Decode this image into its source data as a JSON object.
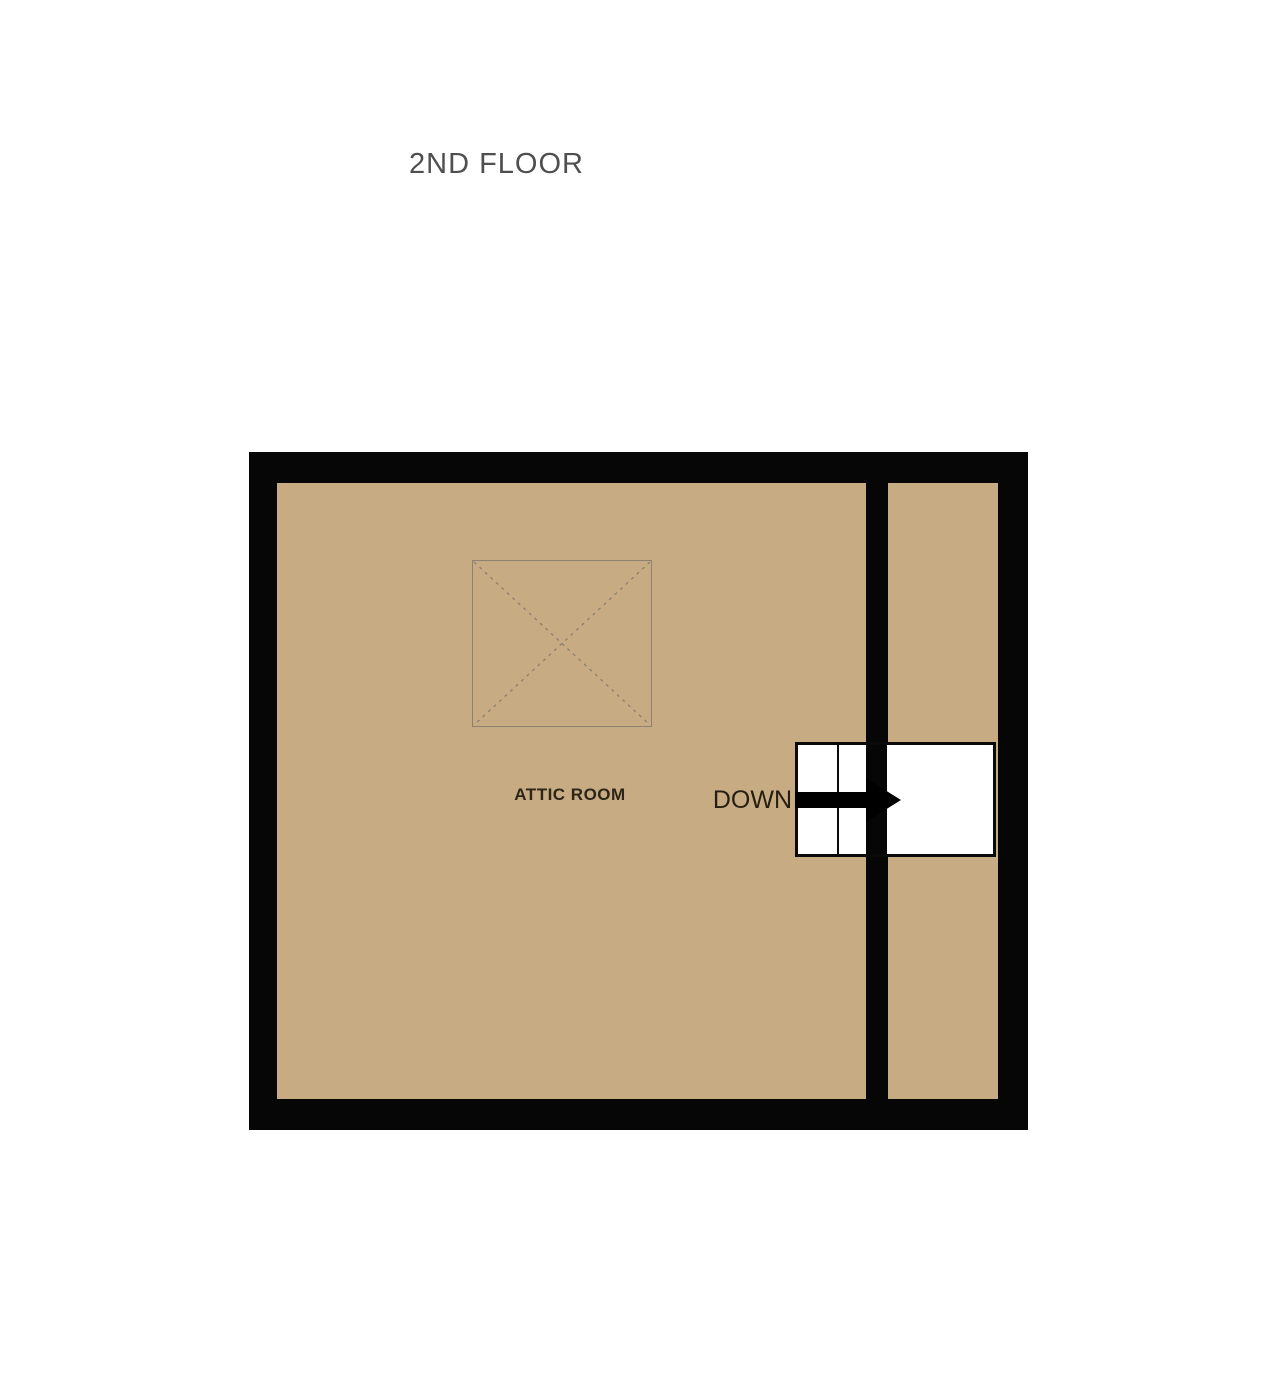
{
  "title": "2ND FLOOR",
  "floor_plan": {
    "room_label": "ATTIC ROOM",
    "stairs_label": "DOWN",
    "features": {
      "ceiling_opening": "dashed X box (roof/ceiling opening)",
      "staircase_direction": "down, arrow pointing right"
    },
    "colors": {
      "wall": "#060606",
      "floor_fill": "#c7ab83",
      "stairs_fill": "#ffffff",
      "dashed_outline": "#8f8170",
      "title_text": "#4f4f4f",
      "room_label_text": "#2d2517",
      "stairs_label_text": "#261e10",
      "arrow": "#000000",
      "page_background": "#ffffff"
    }
  }
}
